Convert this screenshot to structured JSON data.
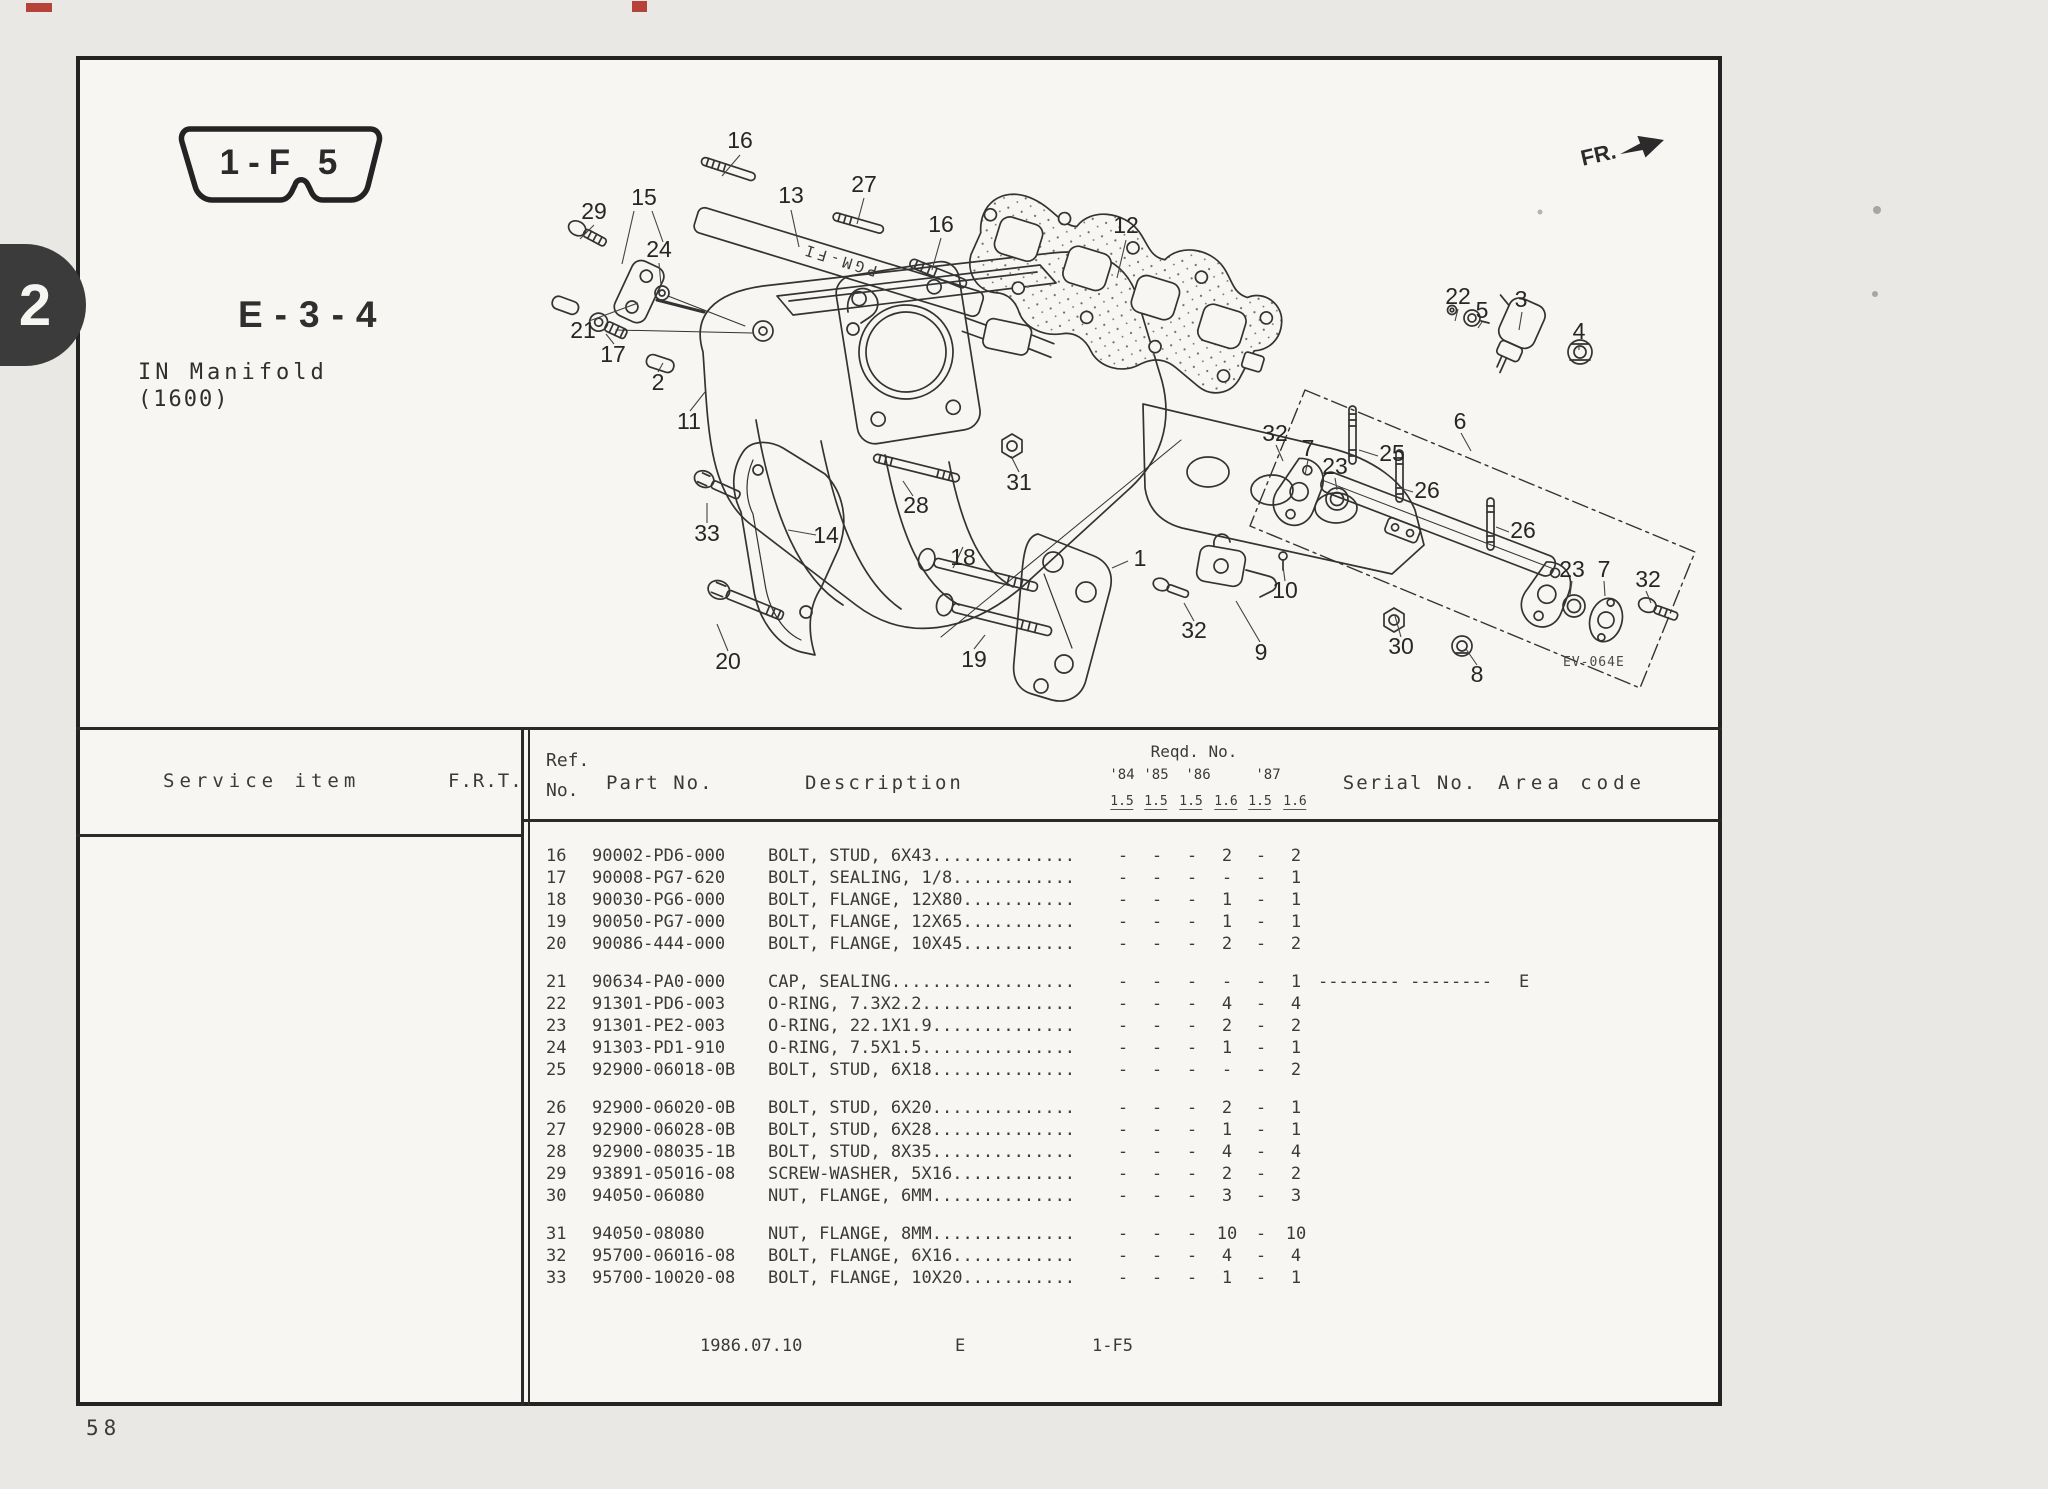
{
  "page": {
    "tab_number": "2",
    "page_number": "58",
    "frame_code": "1-F 5",
    "section_code": "E-3-4",
    "title_line1": "IN Manifold",
    "title_line2": "(1600)",
    "fr_label": "FR.",
    "plate_text": "PGM-FI",
    "diagram_code": "EV-064E",
    "footer_date": "1986.07.10",
    "footer_section": "E",
    "footer_frame": "1-F5"
  },
  "colors": {
    "ink": "#333333",
    "paper": "#f7f6f3",
    "scan_mark_red": "#b5433a",
    "tab_black": "#3b3b3b"
  },
  "diagram": {
    "callouts": [
      {
        "n": "16",
        "x": 740,
        "y": 142
      },
      {
        "n": "13",
        "x": 791,
        "y": 197
      },
      {
        "n": "27",
        "x": 864,
        "y": 186
      },
      {
        "n": "16",
        "x": 941,
        "y": 226
      },
      {
        "n": "12",
        "x": 1126,
        "y": 227
      },
      {
        "n": "29",
        "x": 594,
        "y": 213
      },
      {
        "n": "15",
        "x": 644,
        "y": 199
      },
      {
        "n": "24",
        "x": 659,
        "y": 251
      },
      {
        "n": "21",
        "x": 583,
        "y": 332
      },
      {
        "n": "17",
        "x": 613,
        "y": 356
      },
      {
        "n": "2",
        "x": 658,
        "y": 384
      },
      {
        "n": "11",
        "x": 689,
        "y": 423
      },
      {
        "n": "33",
        "x": 707,
        "y": 535
      },
      {
        "n": "14",
        "x": 826,
        "y": 537
      },
      {
        "n": "28",
        "x": 916,
        "y": 507
      },
      {
        "n": "31",
        "x": 1019,
        "y": 484
      },
      {
        "n": "18",
        "x": 963,
        "y": 559
      },
      {
        "n": "19",
        "x": 974,
        "y": 661
      },
      {
        "n": "1",
        "x": 1140,
        "y": 560
      },
      {
        "n": "20",
        "x": 728,
        "y": 663
      },
      {
        "n": "32",
        "x": 1194,
        "y": 632
      },
      {
        "n": "9",
        "x": 1261,
        "y": 654
      },
      {
        "n": "10",
        "x": 1285,
        "y": 592
      },
      {
        "n": "30",
        "x": 1401,
        "y": 648
      },
      {
        "n": "8",
        "x": 1477,
        "y": 676
      },
      {
        "n": "22",
        "x": 1458,
        "y": 298
      },
      {
        "n": "5",
        "x": 1482,
        "y": 312
      },
      {
        "n": "3",
        "x": 1521,
        "y": 301
      },
      {
        "n": "4",
        "x": 1579,
        "y": 333
      },
      {
        "n": "6",
        "x": 1460,
        "y": 423
      },
      {
        "n": "32",
        "x": 1275,
        "y": 435
      },
      {
        "n": "7",
        "x": 1308,
        "y": 450
      },
      {
        "n": "23",
        "x": 1335,
        "y": 468
      },
      {
        "n": "25",
        "x": 1392,
        "y": 455
      },
      {
        "n": "26",
        "x": 1427,
        "y": 492
      },
      {
        "n": "26",
        "x": 1523,
        "y": 532
      },
      {
        "n": "23",
        "x": 1572,
        "y": 571
      },
      {
        "n": "7",
        "x": 1604,
        "y": 571
      },
      {
        "n": "32",
        "x": 1648,
        "y": 581
      }
    ]
  },
  "table": {
    "headers": {
      "service_item": "Service  item",
      "frt": "F.R.T.",
      "ref_line1": "Ref.",
      "ref_line2": "No.",
      "part_no": "Part No.",
      "description": "Description",
      "reqd_no": "Reqd. No.",
      "years": [
        "'84",
        "'85",
        "'86",
        "'87"
      ],
      "engines": [
        "1.5",
        "1.5",
        "1.5",
        "1.6",
        "1.5",
        "1.6"
      ],
      "serial_no": "Serial No.",
      "area_code": "Area code"
    },
    "rows": [
      {
        "ref": "16",
        "part": "90002-PD6-000",
        "desc": "BOLT, STUD, 6X43..............",
        "qty": [
          "-",
          "-",
          "-",
          "2",
          "-",
          "2"
        ],
        "serial": "",
        "area": "",
        "gap": false
      },
      {
        "ref": "17",
        "part": "90008-PG7-620",
        "desc": "BOLT, SEALING, 1/8............",
        "qty": [
          "-",
          "-",
          "-",
          "-",
          "-",
          "1"
        ],
        "serial": "",
        "area": "",
        "gap": false
      },
      {
        "ref": "18",
        "part": "90030-PG6-000",
        "desc": "BOLT, FLANGE, 12X80...........",
        "qty": [
          "-",
          "-",
          "-",
          "1",
          "-",
          "1"
        ],
        "serial": "",
        "area": "",
        "gap": false
      },
      {
        "ref": "19",
        "part": "90050-PG7-000",
        "desc": "BOLT, FLANGE, 12X65...........",
        "qty": [
          "-",
          "-",
          "-",
          "1",
          "-",
          "1"
        ],
        "serial": "",
        "area": "",
        "gap": false
      },
      {
        "ref": "20",
        "part": "90086-444-000",
        "desc": "BOLT, FLANGE, 10X45...........",
        "qty": [
          "-",
          "-",
          "-",
          "2",
          "-",
          "2"
        ],
        "serial": "",
        "area": "",
        "gap": false
      },
      {
        "ref": "21",
        "part": "90634-PA0-000",
        "desc": "CAP, SEALING..................",
        "qty": [
          "-",
          "-",
          "-",
          "-",
          "-",
          "1"
        ],
        "serial": "-------- --------",
        "area": "E",
        "gap": true
      },
      {
        "ref": "22",
        "part": "91301-PD6-003",
        "desc": "O-RING, 7.3X2.2...............",
        "qty": [
          "-",
          "-",
          "-",
          "4",
          "-",
          "4"
        ],
        "serial": "",
        "area": "",
        "gap": false
      },
      {
        "ref": "23",
        "part": "91301-PE2-003",
        "desc": "O-RING, 22.1X1.9..............",
        "qty": [
          "-",
          "-",
          "-",
          "2",
          "-",
          "2"
        ],
        "serial": "",
        "area": "",
        "gap": false
      },
      {
        "ref": "24",
        "part": "91303-PD1-910",
        "desc": "O-RING, 7.5X1.5...............",
        "qty": [
          "-",
          "-",
          "-",
          "1",
          "-",
          "1"
        ],
        "serial": "",
        "area": "",
        "gap": false
      },
      {
        "ref": "25",
        "part": "92900-06018-0B",
        "desc": "BOLT, STUD, 6X18..............",
        "qty": [
          "-",
          "-",
          "-",
          "-",
          "-",
          "2"
        ],
        "serial": "",
        "area": "",
        "gap": false
      },
      {
        "ref": "26",
        "part": "92900-06020-0B",
        "desc": "BOLT, STUD, 6X20..............",
        "qty": [
          "-",
          "-",
          "-",
          "2",
          "-",
          "1"
        ],
        "serial": "",
        "area": "",
        "gap": true
      },
      {
        "ref": "27",
        "part": "92900-06028-0B",
        "desc": "BOLT, STUD, 6X28..............",
        "qty": [
          "-",
          "-",
          "-",
          "1",
          "-",
          "1"
        ],
        "serial": "",
        "area": "",
        "gap": false
      },
      {
        "ref": "28",
        "part": "92900-08035-1B",
        "desc": "BOLT, STUD, 8X35..............",
        "qty": [
          "-",
          "-",
          "-",
          "4",
          "-",
          "4"
        ],
        "serial": "",
        "area": "",
        "gap": false
      },
      {
        "ref": "29",
        "part": "93891-05016-08",
        "desc": "SCREW-WASHER, 5X16............",
        "qty": [
          "-",
          "-",
          "-",
          "2",
          "-",
          "2"
        ],
        "serial": "",
        "area": "",
        "gap": false
      },
      {
        "ref": "30",
        "part": "94050-06080",
        "desc": "NUT, FLANGE, 6MM..............",
        "qty": [
          "-",
          "-",
          "-",
          "3",
          "-",
          "3"
        ],
        "serial": "",
        "area": "",
        "gap": false
      },
      {
        "ref": "31",
        "part": "94050-08080",
        "desc": "NUT, FLANGE, 8MM..............",
        "qty": [
          "-",
          "-",
          "-",
          "10",
          "-",
          "10"
        ],
        "serial": "",
        "area": "",
        "gap": true
      },
      {
        "ref": "32",
        "part": "95700-06016-08",
        "desc": "BOLT, FLANGE, 6X16............",
        "qty": [
          "-",
          "-",
          "-",
          "4",
          "-",
          "4"
        ],
        "serial": "",
        "area": "",
        "gap": false
      },
      {
        "ref": "33",
        "part": "95700-10020-08",
        "desc": "BOLT, FLANGE, 10X20...........",
        "qty": [
          "-",
          "-",
          "-",
          "1",
          "-",
          "1"
        ],
        "serial": "",
        "area": "",
        "gap": false
      }
    ]
  }
}
